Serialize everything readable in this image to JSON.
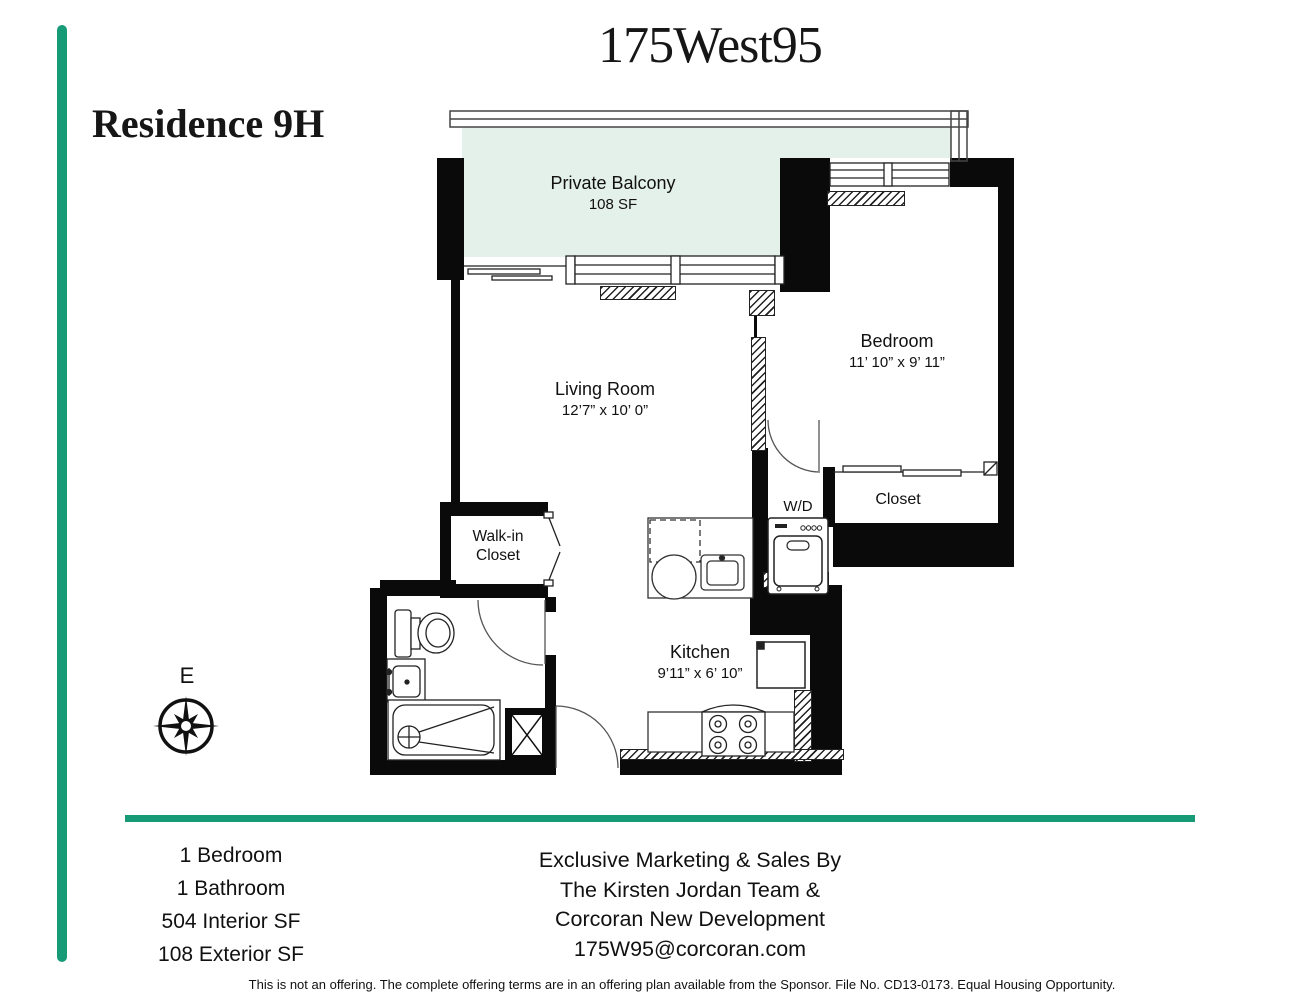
{
  "title": {
    "logo": "175West95",
    "residence": "Residence 9H"
  },
  "plan": {
    "balcony": {
      "name": "Private Balcony",
      "area": "108 SF"
    },
    "living_room": {
      "name": "Living Room",
      "dims": "12’7” x 10’ 0”"
    },
    "bedroom": {
      "name": "Bedroom",
      "dims": "11’ 10” x 9’ 11”"
    },
    "walk_in_closet": {
      "name_line1": "Walk-in",
      "name_line2": "Closet"
    },
    "bedroom_closet": {
      "name": "Closet"
    },
    "laundry": {
      "name": "W/D"
    },
    "kitchen": {
      "name": "Kitchen",
      "dims": "9’11” x 6’ 10”"
    },
    "compass": {
      "label": "E"
    }
  },
  "summary": {
    "lines": [
      "1 Bedroom",
      "1 Bathroom",
      "504 Interior SF",
      "108 Exterior SF"
    ]
  },
  "marketing": {
    "lines": [
      "Exclusive Marketing & Sales By",
      "The Kirsten Jordan Team &",
      "Corcoran New Development",
      "175W95@corcoran.com"
    ]
  },
  "disclaimer": "This is not an offering. The complete offering terms are in an offering plan available from the Sponsor. File No. CD13-0173. Equal Housing Opportunity.",
  "colors": {
    "accent_green": "#169B76",
    "balcony_fill": "#E4F0EA",
    "wall_black": "#0A0A0A"
  }
}
